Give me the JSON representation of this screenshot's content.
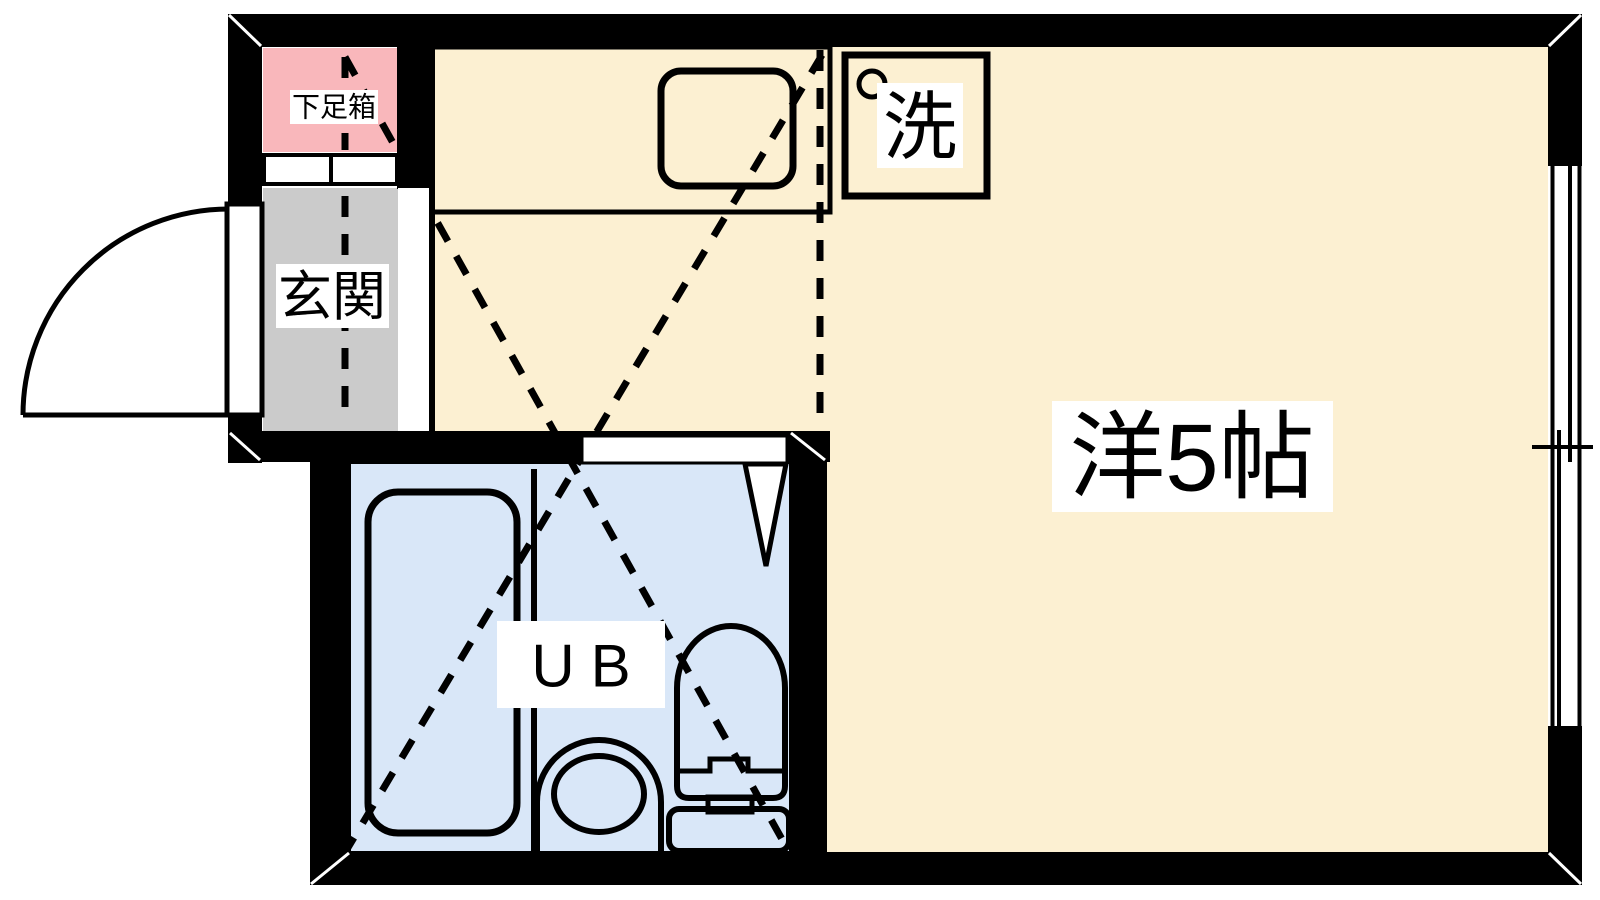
{
  "plan": {
    "kind": "apartment-floor-plan",
    "rooms": {
      "shoe_box": {
        "label": "下足箱"
      },
      "entrance": {
        "label": "玄関"
      },
      "washer": {
        "label": "洗"
      },
      "unit_bath": {
        "label": "UB"
      },
      "main_room": {
        "label": "洋5帖"
      }
    },
    "colors": {
      "wall": "#000000",
      "room_floor": "#fcf0d2",
      "entrance_floor": "#cbcbcb",
      "shoe_box_fill": "#f9b7bb",
      "bath_floor": "#d9e7f8",
      "label_bg": "#ffffff",
      "line": "#000000",
      "opening": "#ffffff"
    },
    "fixture_names": [
      "entrance-door",
      "shoe-box-sliding-doors",
      "kitchen-counter",
      "kitchen-sink",
      "washing-machine-space",
      "tap-circle",
      "unit-bath-door",
      "bathtub",
      "wash-basin",
      "toilet",
      "sliding-window"
    ]
  }
}
